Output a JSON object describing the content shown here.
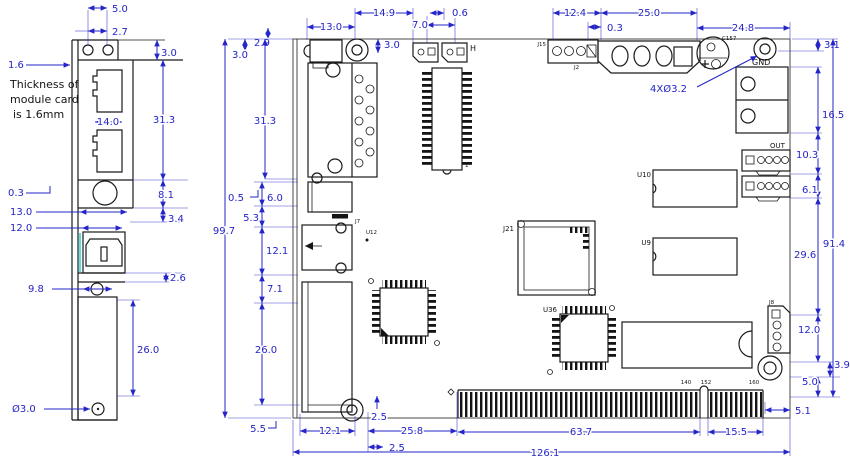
{
  "colors": {
    "dimension_blue": "#2424c8",
    "drawing_black": "#1a1a1a",
    "background": "#ffffff",
    "cyan_accent": "#1ad0d0"
  },
  "side_view": {
    "dims": {
      "hole_pitch": "5.0",
      "hole_offset": "2.7",
      "tab_height": "3.0",
      "plate_thickness": "1.6",
      "rj45_width": "14.0",
      "rj45_section_height": "31.3",
      "lip": "0.3",
      "jack_width": "13.0",
      "jack_section_height": "8.1",
      "gap_below_jack": "3.4",
      "usb_width": "12.0",
      "strip_height": "2.6",
      "hole_inset": "9.8",
      "lower_connector_height": "26.0",
      "hole_diameter": "Ø3.0"
    },
    "note_lines": [
      "Thickness of",
      "module card",
      "is 1.6mm"
    ]
  },
  "board_view": {
    "dims_top": {
      "jack_width": "13.0",
      "jack_to_hole": "14.9",
      "jack_overhang": "2.9",
      "edge_offset_left": "3.0",
      "hole_offset": "3.0",
      "header_pitch": "7.0",
      "header_gap": "0.6",
      "j15_width": "12.4",
      "j15_to_j2": "0.3",
      "j2_width": "25.0",
      "j2_to_edge": "24.8"
    },
    "dims_right": {
      "hole_top_offset": "3.1",
      "terminal_height": "16.5",
      "seg_10_3": "10.3",
      "seg_6_1": "6.1",
      "seg_29_6": "29.6",
      "j8_height": "12.0",
      "seg_3_9": "3.9",
      "seg_5_0": "5.0",
      "edge_inset": "5.1",
      "overall_height": "91.4"
    },
    "dims_left": {
      "db_section": "31.3",
      "edge_lip": "0.5",
      "seg_6_0": "6.0",
      "seg_5_3": "5.3",
      "usb_height": "12.1",
      "seg_7_1": "7.1",
      "connector_height": "26.0",
      "corner_offset": "5.5",
      "overall_height": "99.7"
    },
    "dims_bottom": {
      "block_width": "12.1",
      "hole_offset_v": "2.5",
      "hole_offset_h": "2.5",
      "to_fingers": "25.8",
      "finger_seg_main": "63.7",
      "finger_seg_small": "15.5",
      "overall_width": "126.1"
    },
    "hole_callout": "4XØ3.2",
    "component_labels": {
      "gnd": "GND",
      "out": "OUT",
      "h": "H",
      "c157": "C157",
      "j15": "J15",
      "j2": "J2",
      "j21": "J21",
      "j7": "J7",
      "j8": "J8",
      "u9": "U9",
      "u10": "U10",
      "u12": "U12",
      "u36": "U36",
      "pin1": "1",
      "finger_a": "140",
      "finger_b": "152",
      "finger_c": "160"
    }
  }
}
